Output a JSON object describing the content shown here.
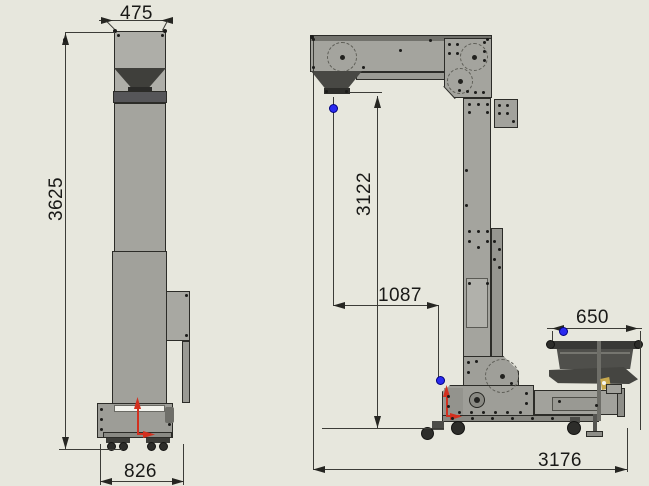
{
  "drawing": {
    "front_view": {
      "dim_top_width": "475",
      "dim_overall_height": "3625",
      "dim_base_width": "826"
    },
    "side_view": {
      "dim_vertical_height": "3122",
      "dim_discharge_offset": "1087",
      "dim_infeed_hopper_width": "650",
      "dim_overall_length": "3176"
    },
    "icons": {
      "vertex_marker": "blue-dot",
      "origin_axis_marker": "red-arrow",
      "sprocket_pitch_circle": "dashed-circle"
    },
    "colors": {
      "background": "#e7e7dd",
      "body_gray": "#a4a49e",
      "dark_part": "#464642",
      "outline": "#2c2c28",
      "origin_red": "#d2301f",
      "vertex_blue": "#2a2af0",
      "dimension_text": "#191917"
    }
  }
}
